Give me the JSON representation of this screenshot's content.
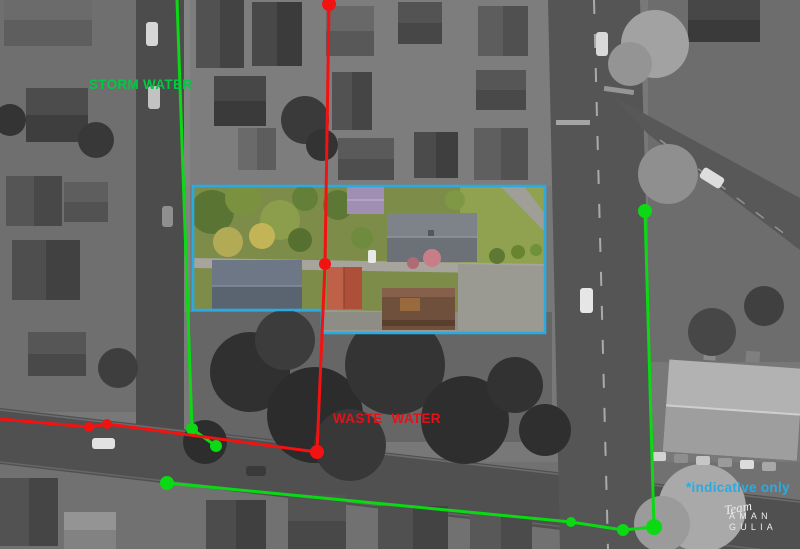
{
  "annotations": {
    "storm_water": {
      "label": "STORM WATER",
      "label_color": "#00c943",
      "line_color": "#0bd914",
      "lines": [
        {
          "points": [
            [
              177,
              0
            ],
            [
              192,
              429
            ],
            [
              216,
              446
            ]
          ],
          "dots": [
            [
              192,
              429,
              6
            ],
            [
              216,
              446,
              6
            ]
          ]
        },
        {
          "points": [
            [
              167,
              483
            ],
            [
              571,
              522
            ],
            [
              623,
              530
            ],
            [
              654,
              527
            ],
            [
              645,
              211
            ]
          ],
          "dots": [
            [
              167,
              483,
              7
            ],
            [
              571,
              522,
              5
            ],
            [
              623,
              530,
              6
            ],
            [
              654,
              527,
              8
            ],
            [
              645,
              211,
              7
            ]
          ]
        }
      ]
    },
    "waste_water": {
      "label": "WASTE WATER",
      "label_color": "#e31219",
      "line_color": "#f31212",
      "lines": [
        {
          "points": [
            [
              0,
              419
            ],
            [
              89,
              427
            ],
            [
              107,
              424
            ],
            [
              317,
              452
            ],
            [
              325,
              264
            ],
            [
              329,
              4
            ]
          ],
          "dots": [
            [
              89,
              427,
              5
            ],
            [
              107,
              424,
              5
            ],
            [
              317,
              452,
              7
            ],
            [
              325,
              264,
              6
            ],
            [
              329,
              4,
              7
            ]
          ]
        }
      ]
    },
    "property_boundary": {
      "color": "#29abe2",
      "points": [
        [
          193,
          186
        ],
        [
          545,
          186
        ],
        [
          545,
          333
        ],
        [
          322,
          333
        ],
        [
          322,
          310
        ],
        [
          193,
          310
        ]
      ]
    },
    "indicative_note": {
      "label": "*indicative only",
      "color": "#29abe2"
    }
  },
  "logo": {
    "script_word": "Team",
    "name_line1": "AMAN",
    "name_line2": "GULIA"
  }
}
